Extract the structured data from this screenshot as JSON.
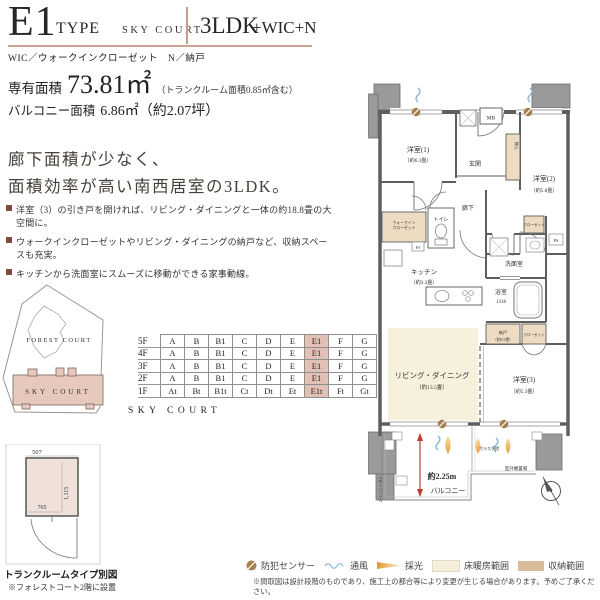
{
  "header": {
    "type_code": "E1",
    "type_word": "TYPE",
    "building": "SKY COURT",
    "layout_main": "3LDK",
    "layout_sub": "+WIC+N",
    "abbreviations": "WIC／ウォークインクローゼット　N／納戸"
  },
  "areas": {
    "exclusive_label": "専有面積",
    "exclusive_value": "73.81㎡",
    "exclusive_note": "（トランクルーム面積0.85㎡含む）",
    "balcony_label": "バルコニー面積",
    "balcony_value": "6.86㎡（約2.07坪）"
  },
  "headline": {
    "line1": "廊下面積が少なく、",
    "line2": "面積効率が高い南西居室の3LDK。"
  },
  "bullets": [
    "洋室（3）の引き戸を開ければ、リビング・ダイニングと一体の約18.8畳の大空間に。",
    "ウォークインクローゼットやリビング・ダイニングの納戸など、収納スペースも充実。",
    "キッチンから洗面室にスムーズに移動ができる家事動線。"
  ],
  "site_map": {
    "forest_label": "FOREST COURT",
    "sky_label": "SKY COURT"
  },
  "floor_table": {
    "caption": "SKY COURT",
    "rows": [
      {
        "floor": "5F",
        "cells": [
          "A",
          "B",
          "B1",
          "C",
          "D",
          "E",
          "E1",
          "F",
          "G"
        ]
      },
      {
        "floor": "4F",
        "cells": [
          "A",
          "B",
          "B1",
          "C",
          "D",
          "E",
          "E1",
          "F",
          "G"
        ]
      },
      {
        "floor": "3F",
        "cells": [
          "A",
          "B",
          "B1",
          "C",
          "D",
          "E",
          "E1",
          "F",
          "G"
        ]
      },
      {
        "floor": "2F",
        "cells": [
          "A",
          "B",
          "B1",
          "C",
          "D",
          "E",
          "E1",
          "F",
          "G"
        ]
      },
      {
        "floor": "1F",
        "cells": [
          "At",
          "Bt",
          "B1t",
          "Ct",
          "Dt",
          "Et",
          "E1t",
          "Ft",
          "Gt"
        ]
      }
    ]
  },
  "trunk_room": {
    "dim_top": "507",
    "dim_right": "1,115",
    "dim_bottom": "765",
    "caption": "トランクルームタイプ別図",
    "note": "※フォレストコート2階に設置"
  },
  "floor_plan": {
    "labels": {
      "bedroom1": "洋室(1)",
      "bedroom1_size": "（約6.3畳）",
      "bedroom2": "洋室(2)",
      "bedroom2_size": "（約5.8畳）",
      "bedroom3": "洋室(3)",
      "bedroom3_size": "（約5.3畳）",
      "living": "リビング・ダイニング",
      "living_size": "（約13.5畳）",
      "kitchen": "キッチン",
      "kitchen_size": "（約3.3畳）",
      "entrance": "玄関",
      "hallway": "廊下",
      "toilet": "トイレ",
      "wic1": "ウォークイン",
      "wic2": "クローゼット",
      "washroom": "洗面室",
      "bath": "浴室",
      "bath_size": "1418",
      "mb": "MB",
      "monoire": "物入",
      "nando": "納戸",
      "nando_size": "（約0.5畳）",
      "closet_a": "クローゼット",
      "closet_b": "クローゼット",
      "balcony": "バルコニー",
      "depth": "約2.25m",
      "outdoor_unit": "室外機置場",
      "glass_rail": "ガラス手摺",
      "slop_sink": "スロップシンク",
      "fs": "FS",
      "ps": "PS"
    }
  },
  "legend": {
    "items": [
      {
        "label": "防犯センサー"
      },
      {
        "label": "通風"
      },
      {
        "label": "採光"
      },
      {
        "label": "床暖房範囲"
      },
      {
        "label": "収納範囲"
      }
    ],
    "disclaimer": "※間取図は設計段階のものであり、施工上の都合等により変更が生じる場合があります。予めご了承ください。"
  },
  "colors": {
    "accent_pink": "#e2c1b4",
    "rule_pink": "#cfa190",
    "storage_tan": "#eedcc2",
    "floor_heating_cream": "#f6f0dc",
    "wall_gray": "#5e5e5e",
    "red_dim": "#c23b2e",
    "vent_blue": "#7fb7d8",
    "light_orange": "#e8a33d",
    "sensor_brown": "#a3804d"
  }
}
